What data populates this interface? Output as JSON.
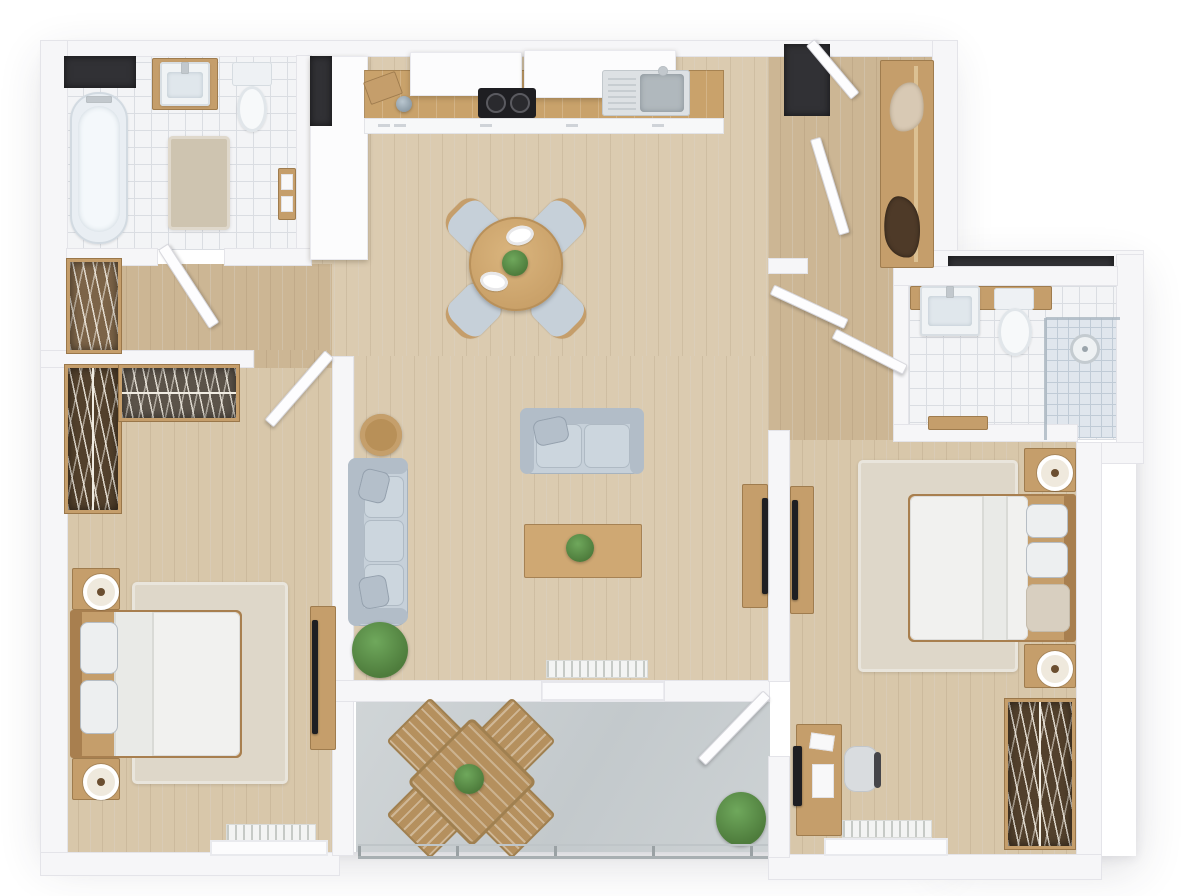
{
  "scene": {
    "title": "3D floor plan — two-bedroom apartment with balcony, top-down view",
    "style": "photoreal 3D render, white walls, light oak floors"
  },
  "palette": {
    "wall": "#f6f6f8",
    "wallEdge": "#e4e4e9",
    "floorMain": "#dbcbb0",
    "floorWarm": "#ccb694",
    "floorBed": "#d8c7aa",
    "tile": "#f3f4f6",
    "tileLine": "#dadde2",
    "tileShower": "#e0e6ed",
    "tileShowerLine": "#c0cbd6",
    "balcony": "#c8cdd0",
    "woodFurn": "#c59e6b",
    "woodDark": "#a87f4f",
    "woodBalc": "#b5905e",
    "counter": "#c9a26b",
    "closetDark": "#52402c",
    "closetGray": "#5b5349",
    "sofa": "#c6d0d9",
    "sofaShade": "#b2bdc8",
    "pillow": "#b4bfca",
    "rug": "#d9d1c2",
    "rugBed": "#ded7c9",
    "applianceDark": "#1e1e22",
    "recess": "#313135",
    "plant": "#4e7c3c",
    "plantLight": "#6fa85c",
    "metal": "#c2c8cd",
    "lampBase": "#efe9dd",
    "lampDot": "#6b4e30"
  },
  "rooms": [
    {
      "id": "bathroom-1",
      "name": "Bathroom 1 (top left)",
      "furniture": [
        "bathtub",
        "washbasin on wood counter",
        "toilet",
        "bath rug",
        "towel shelf",
        "window recess"
      ]
    },
    {
      "id": "kitchen",
      "name": "Kitchen (top center)",
      "furniture": [
        "tall cabinet",
        "wood counter",
        "upper cabinets",
        "cooktop",
        "stainless sink",
        "cutting board",
        "base cabinets"
      ]
    },
    {
      "id": "dining-area",
      "name": "Dining area",
      "furniture": [
        "round wood table",
        "four upholstered chairs",
        "two place settings",
        "table plant"
      ]
    },
    {
      "id": "entry-hall",
      "name": "Entry hall (top right)",
      "furniture": [
        "front door recess",
        "two door leaves",
        "coat wardrobe with rail",
        "light jacket",
        "dark coat"
      ]
    },
    {
      "id": "living-room",
      "name": "Living room (center)",
      "furniture": [
        "three-seat sofa",
        "two-seat sofa",
        "coffee table with plant",
        "round side table",
        "floor plant",
        "TV sideboard with TV",
        "radiator",
        "sliding balcony door"
      ]
    },
    {
      "id": "bathroom-2",
      "name": "Bathroom 2 (right)",
      "furniture": [
        "washbasin on wood counter",
        "toilet",
        "walk-in shower",
        "wood bench",
        "double doors"
      ]
    },
    {
      "id": "walk-in-closet",
      "name": "Walk-in closet (left)",
      "furniture": [
        "hall wardrobe",
        "corner wardrobe long",
        "corner wardrobe short",
        "doors"
      ]
    },
    {
      "id": "bedroom-1",
      "name": "Bedroom 1 (bottom left)",
      "furniture": [
        "double bed",
        "two nightstands with lamps",
        "area rug",
        "TV sideboard with TV",
        "radiator",
        "window"
      ]
    },
    {
      "id": "bedroom-2",
      "name": "Bedroom 2 (right)",
      "furniture": [
        "double bed",
        "two nightstands with lamps",
        "area rug",
        "desk with monitor",
        "office chair",
        "open wardrobe",
        "TV sideboard with TV",
        "radiator",
        "window",
        "balcony door"
      ]
    },
    {
      "id": "balcony",
      "name": "Balcony (bottom center)",
      "furniture": [
        "square slatted table",
        "four slatted chairs",
        "table plant",
        "shrub planter",
        "glass railing"
      ]
    }
  ]
}
